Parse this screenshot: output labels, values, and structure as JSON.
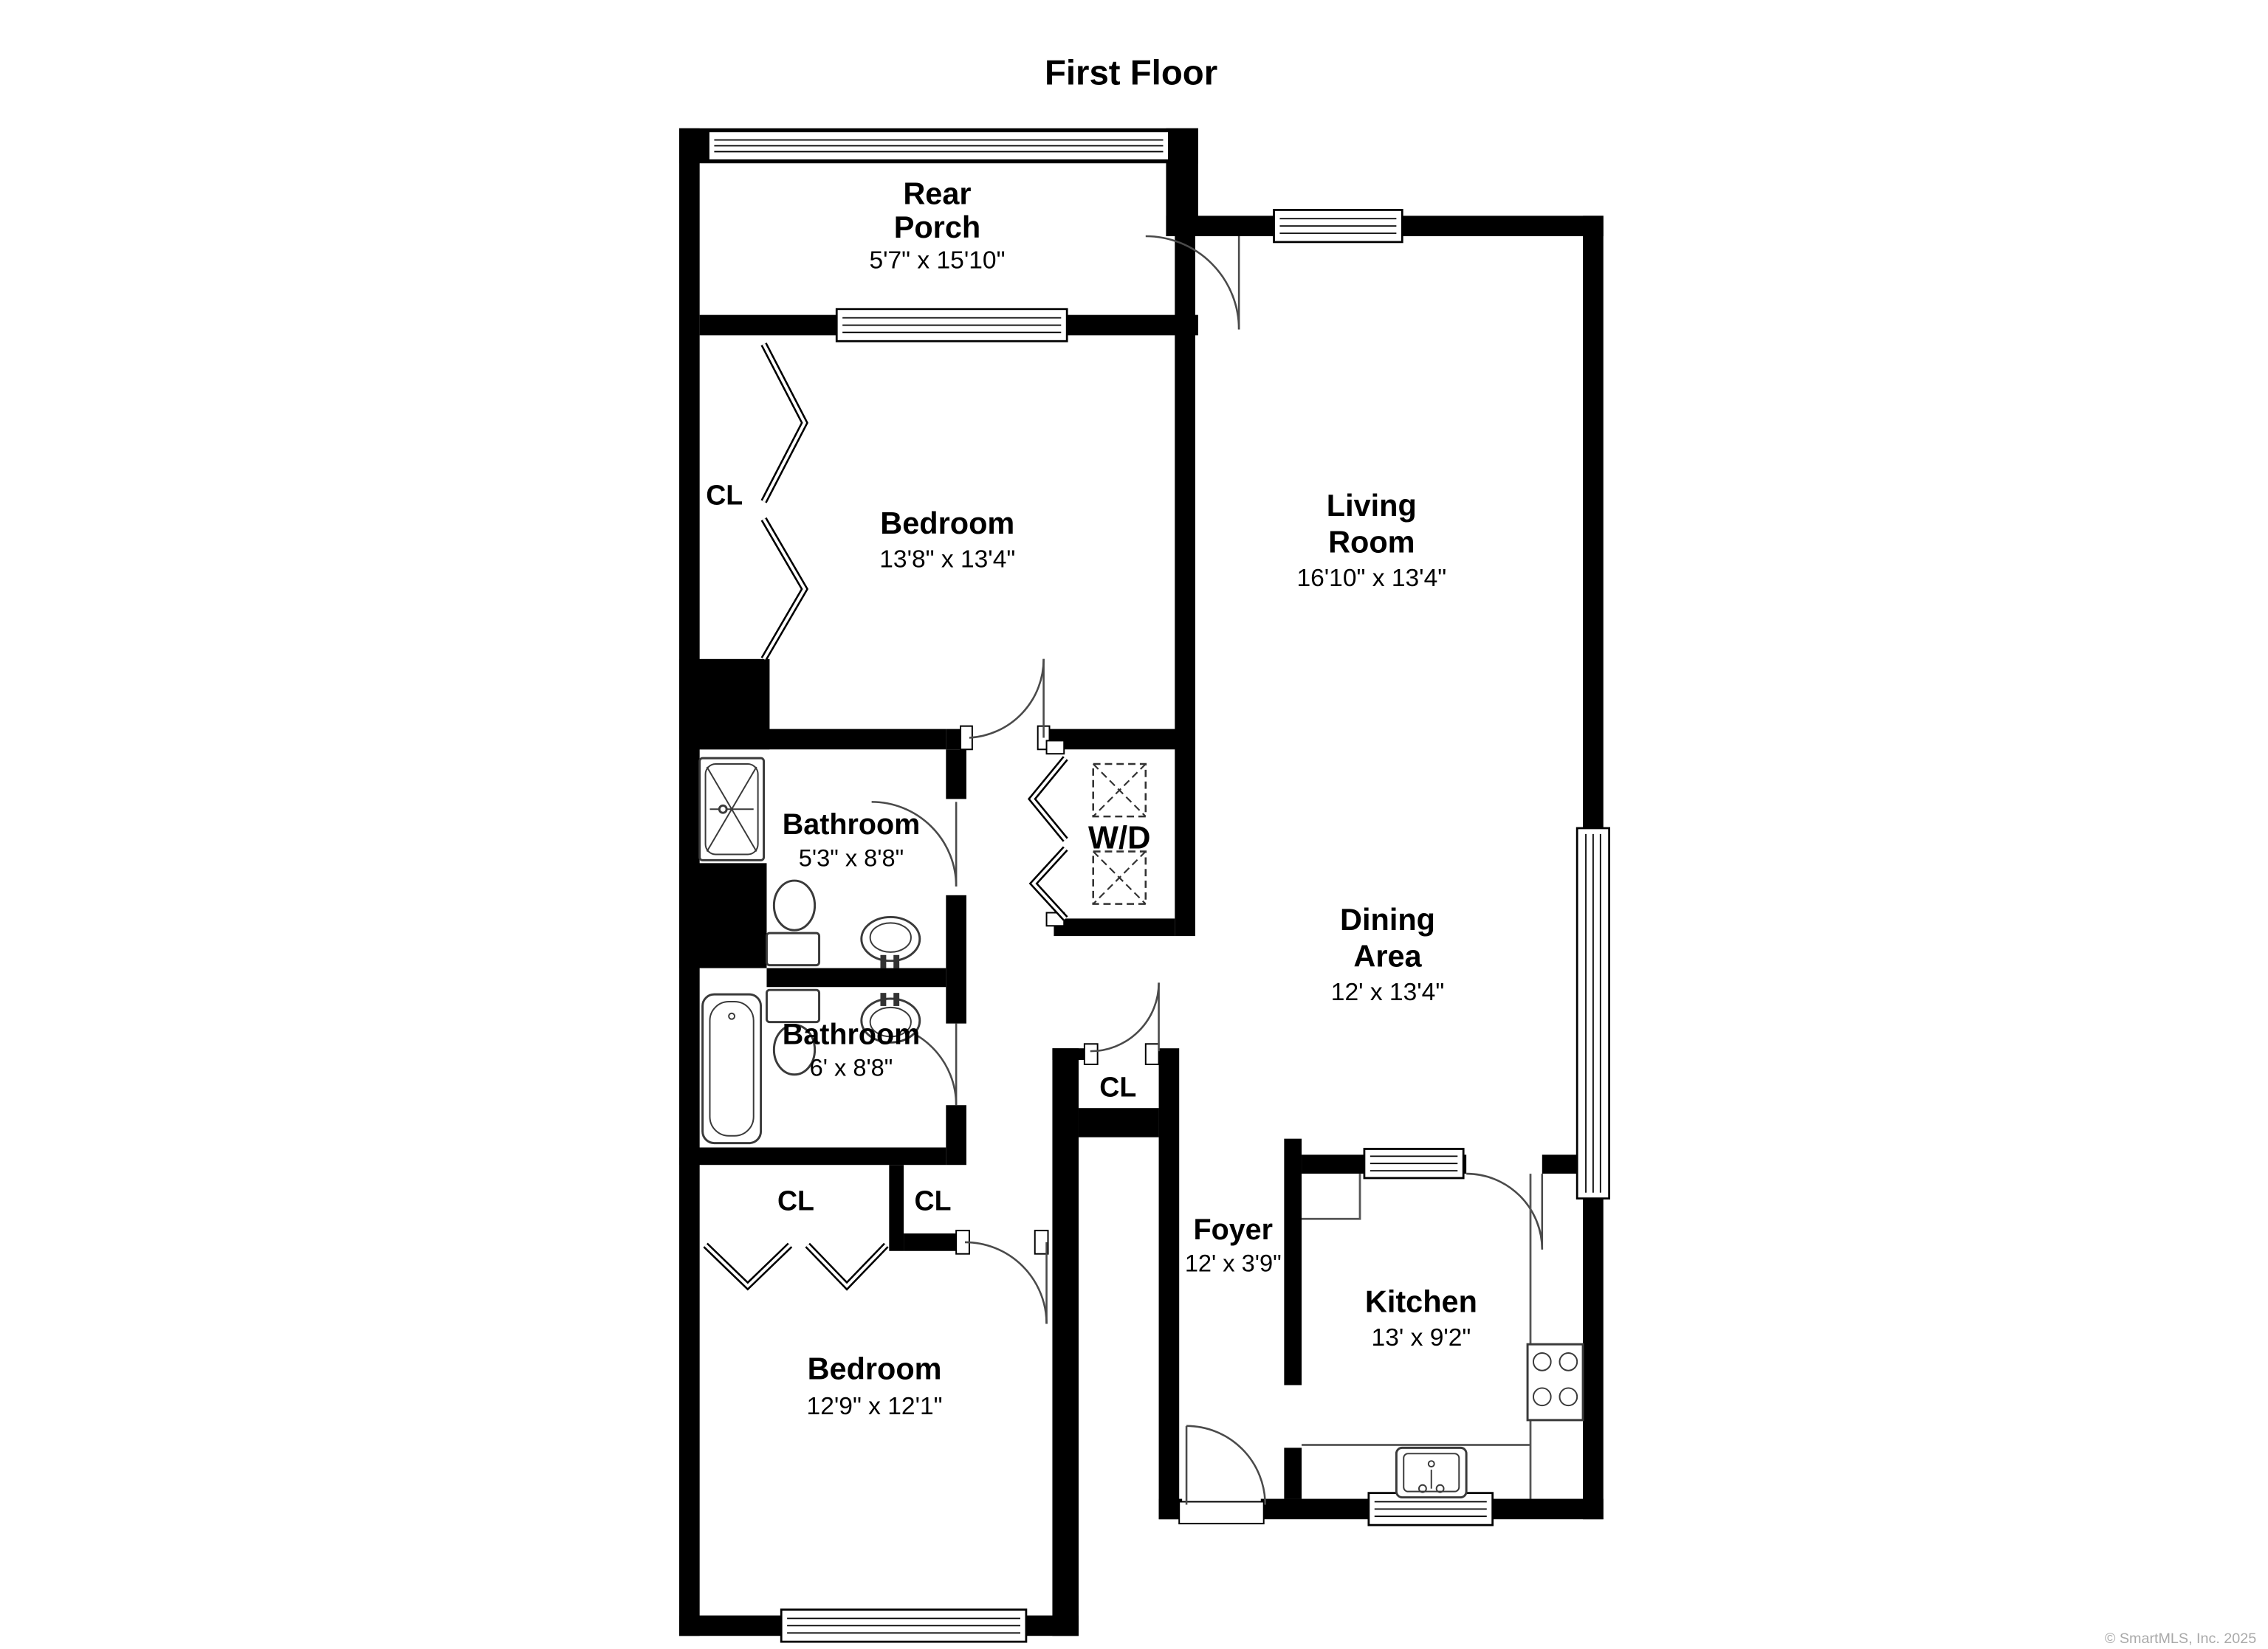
{
  "title": "First Floor",
  "watermark": "© SmartMLS, Inc. 2025",
  "colors": {
    "wall": "#000000",
    "background": "#ffffff",
    "label": "#000000",
    "watermark": "#a9a9a9"
  },
  "rooms": {
    "rear_porch": {
      "line1": "Rear",
      "line2": "Porch",
      "dims": "5'7\" x 15'10\""
    },
    "bedroom_top": {
      "line1": "Bedroom",
      "dims": "13'8\" x 13'4\""
    },
    "living_room": {
      "line1": "Living",
      "line2": "Room",
      "dims": "16'10\" x 13'4\""
    },
    "bathroom_upper": {
      "line1": "Bathroom",
      "dims": "5'3\" x 8'8\""
    },
    "laundry": {
      "line1": "W/D"
    },
    "dining_area": {
      "line1": "Dining",
      "line2": "Area",
      "dims": "12' x 13'4\""
    },
    "bathroom_lower": {
      "line1": "Bathroom",
      "dims": "6' x 8'8\""
    },
    "foyer": {
      "line1": "Foyer",
      "dims": "12' x 3'9\""
    },
    "kitchen": {
      "line1": "Kitchen",
      "dims": "13' x 9'2\""
    },
    "bedroom_bottom": {
      "line1": "Bedroom",
      "dims": "12'9\" x 12'1\""
    }
  },
  "closet_labels": {
    "bedroom_top_closet": "CL",
    "hall_closet": "CL",
    "bedroom_bottom_closet_left": "CL",
    "bedroom_bottom_closet_right": "CL"
  }
}
